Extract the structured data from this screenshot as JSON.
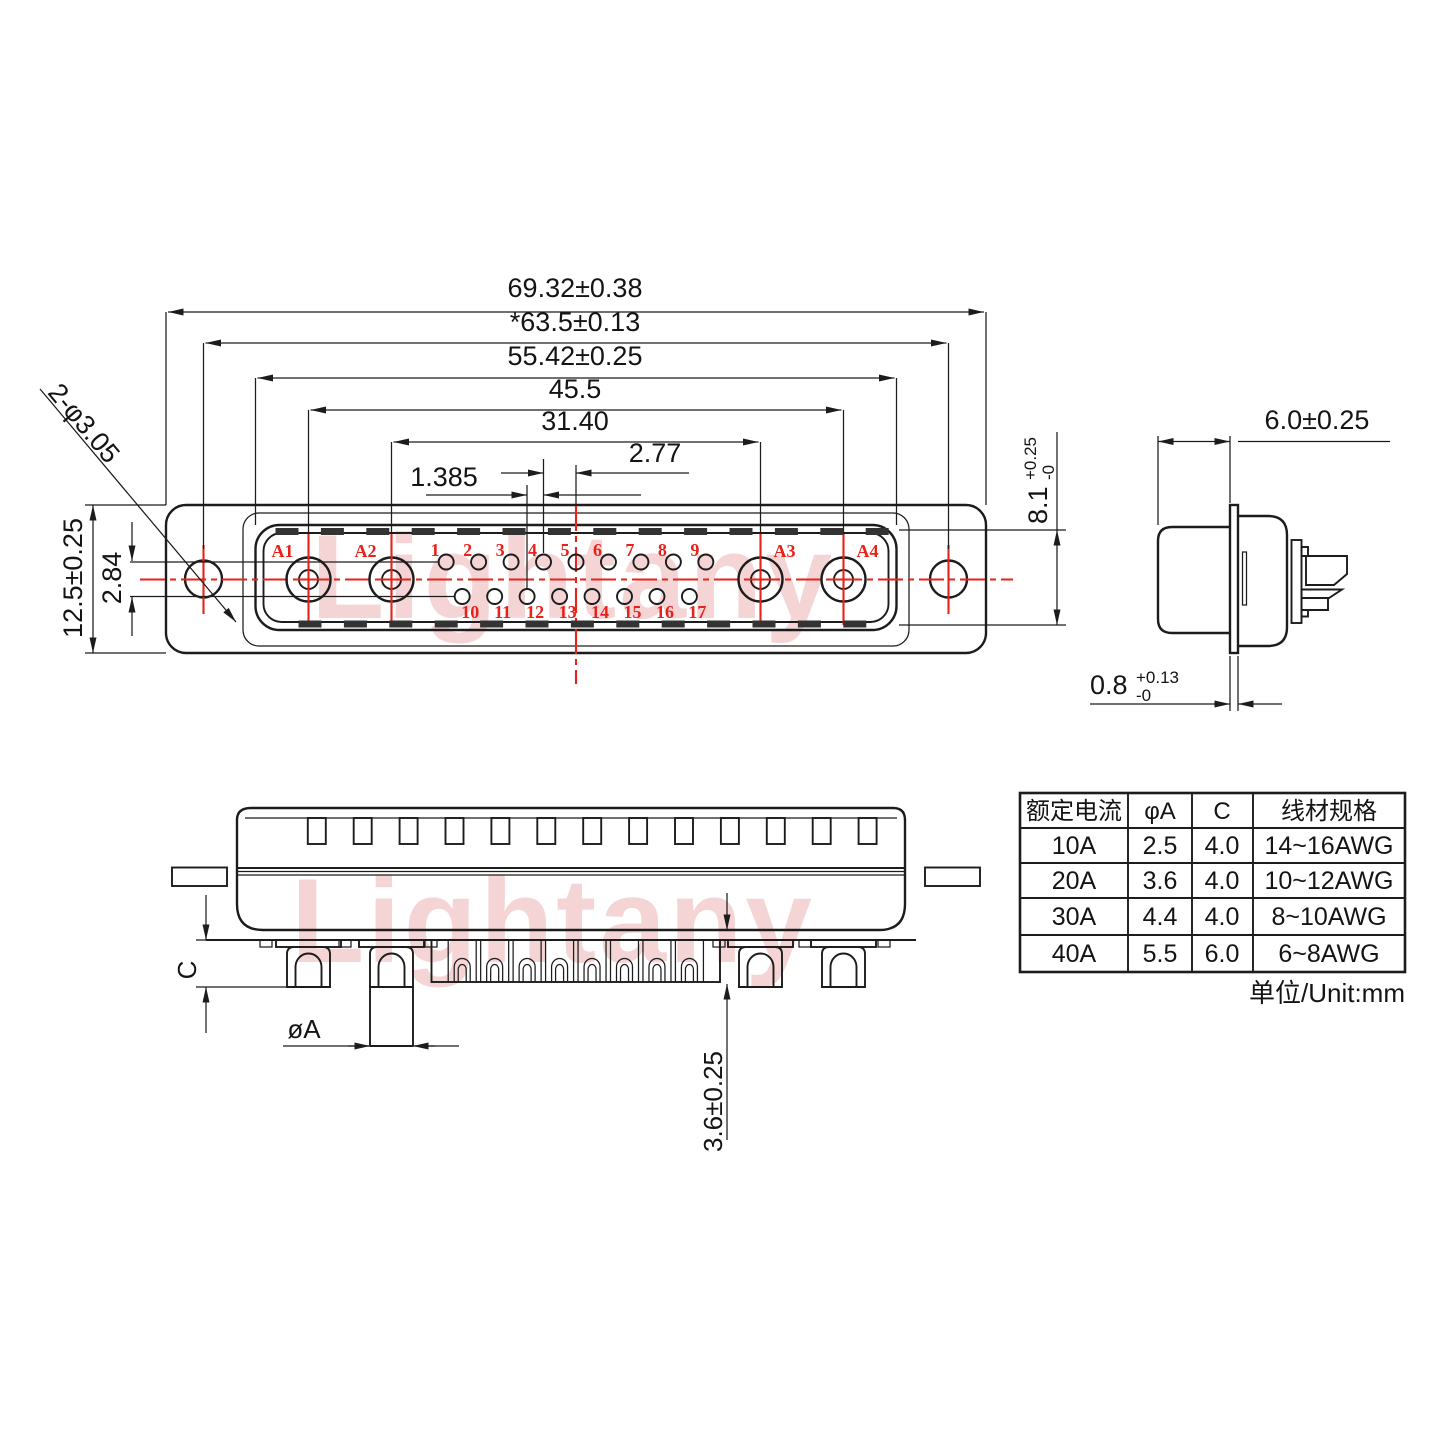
{
  "colors": {
    "line": "#1c1c1c",
    "red": "#e8221a",
    "watermark": "#e59a9a"
  },
  "watermark": {
    "text": "Lightany"
  },
  "front_view": {
    "dims": {
      "overall_width": "69.32±0.38",
      "mount_hole_span": "*63.5±0.13",
      "shell_width": "55.42±0.25",
      "power_pin_span": "45.5",
      "inner_power_span": "31.40",
      "pin_pitch": "2.77",
      "row_offset": "1.385",
      "flange_height": "12.5±0.25",
      "row_gap": "2.84",
      "hole_callout": "2-φ3.05",
      "shell_height_base": "8.1",
      "shell_height_tol_plus": "+0.25",
      "shell_height_tol_minus": "-0"
    },
    "power_pins": [
      "A1",
      "A2",
      "A3",
      "A4"
    ],
    "pins_top": [
      "1",
      "2",
      "3",
      "4",
      "5",
      "6",
      "7",
      "8",
      "9"
    ],
    "pins_bottom": [
      "10",
      "11",
      "12",
      "13",
      "14",
      "15",
      "16",
      "17"
    ]
  },
  "side_view": {
    "dims": {
      "shell_depth": "6.0±0.25",
      "flange_thickness_base": "0.8",
      "flange_thickness_tol_plus": "+0.13",
      "flange_thickness_tol_minus": "-0"
    }
  },
  "bottom_view": {
    "dims": {
      "pin_length": "C",
      "pin_diameter": "øA",
      "pin_tip_length": "3.6±0.25"
    }
  },
  "spec_table": {
    "headers": [
      "额定电流",
      "φA",
      "C",
      "线材规格"
    ],
    "rows": [
      [
        "10A",
        "2.5",
        "4.0",
        "14~16AWG"
      ],
      [
        "20A",
        "3.6",
        "4.0",
        "10~12AWG"
      ],
      [
        "30A",
        "4.4",
        "4.0",
        "8~10AWG"
      ],
      [
        "40A",
        "5.5",
        "6.0",
        "6~8AWG"
      ]
    ],
    "unit_note": "单位/Unit:mm"
  }
}
